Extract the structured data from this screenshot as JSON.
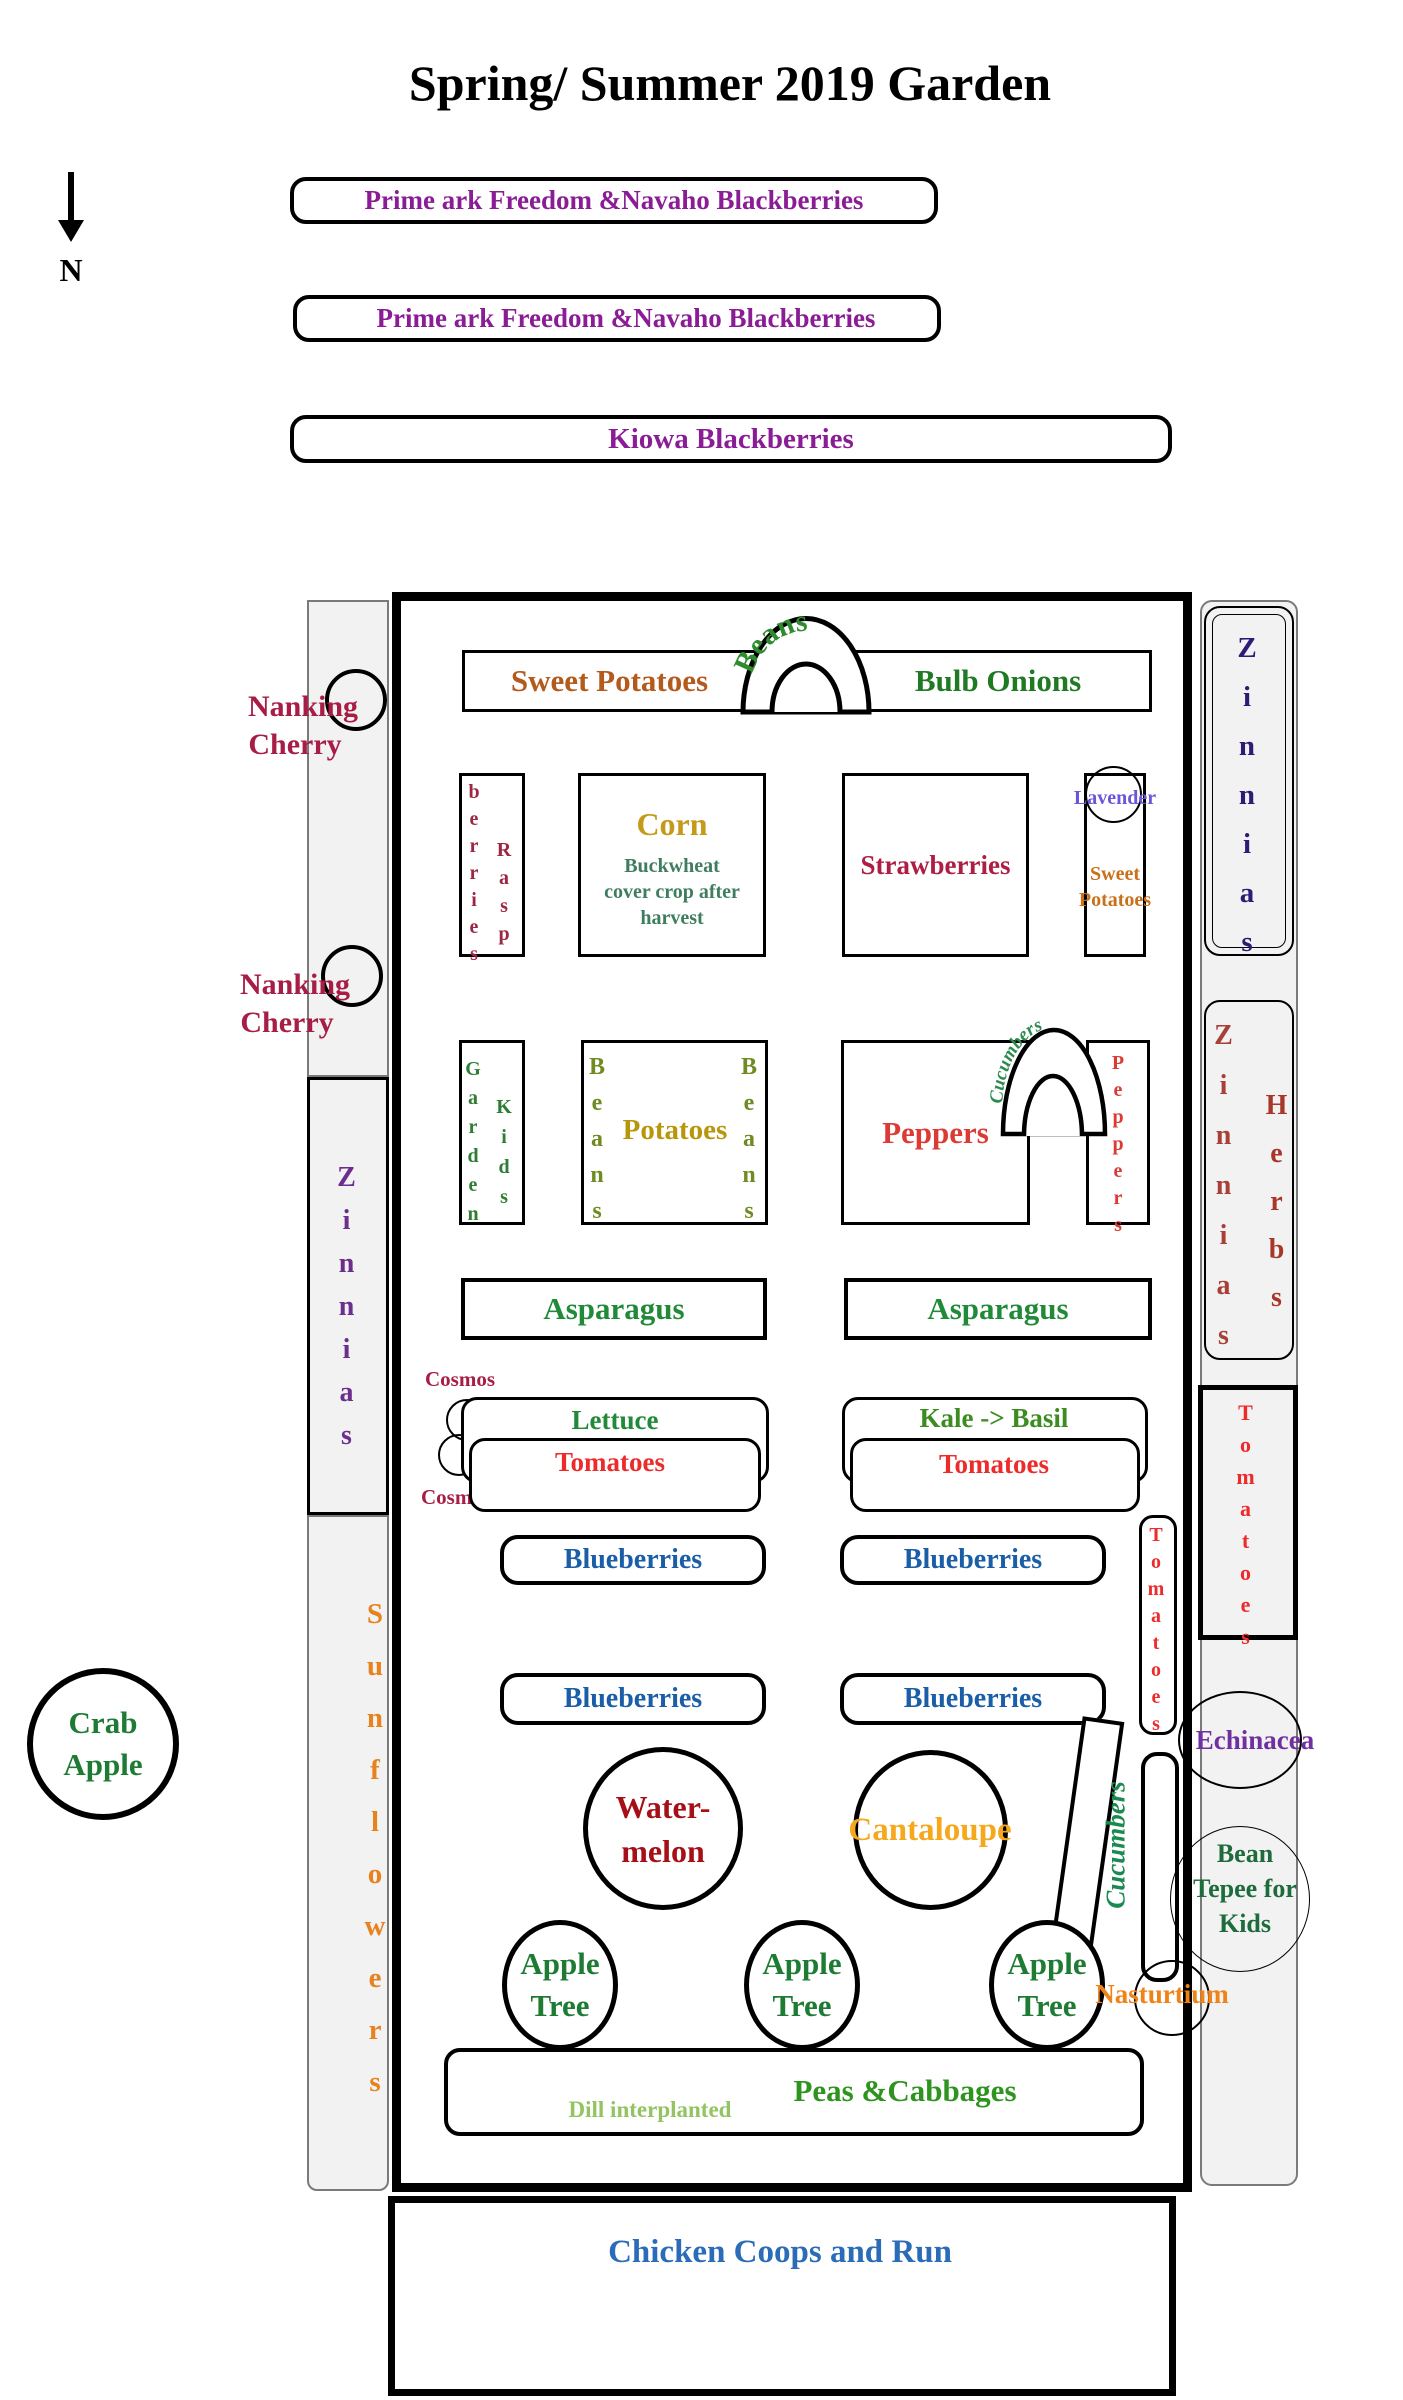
{
  "palette": {
    "blackberry_purple": "#8A1D96",
    "crimson": "#A81D45",
    "maroon_berry": "#9C2742",
    "strawberry_red": "#AE1E44",
    "tomato_red": "#ED2B2B",
    "pepper_red": "#DC3A35",
    "watermelon_dark_red": "#A50F15",
    "brick_zinnia": "#A84038",
    "herb_brick": "#A8372A",
    "orange_sweet_potato": "#B45A1D",
    "orange_small_sweet_potato": "#C8701A",
    "sunflower_orange": "#E8821E",
    "nasturtium_orange": "#F08318",
    "cantaloupe_amber": "#F5A81C",
    "corn_gold": "#C49A18",
    "potato_goldenrod": "#B8960C",
    "olive_beans": "#6F8B21",
    "green_main": "#218A39",
    "dark_green": "#1E7B34",
    "bulb_onion_green": "#1F7A23",
    "kale_green": "#3C8C21",
    "peas_green": "#2E941F",
    "dill_light_green": "#93C461",
    "buckwheat_teal_green": "#3E7D5E",
    "cucumber_green": "#1B8A50",
    "blueberry_blue": "#1A5EA8",
    "chicken_blue": "#2B6CB8",
    "navy_zinnia": "#2F1B75",
    "purple_zinnia": "#6B2D8E",
    "lavender_violet": "#6C55D8",
    "echinacea_purple": "#7030A0",
    "strip_gray": "#F2F2F2"
  },
  "title": "Spring/ Summer 2019 Garden",
  "compass_label": "N",
  "top_beds": {
    "row1": "Prime ark Freedom &Navaho Blackberries",
    "row2": "Prime ark Freedom &Navaho Blackberries",
    "row3": "Kiowa Blackberries"
  },
  "left_side": {
    "nanking1_line1": "Nanking",
    "nanking1_line2": "Cherry",
    "nanking2_line1": "Nanking",
    "nanking2_line2": "Cherry",
    "zinnias": "Zinnias",
    "sunflowers": "Sunflowers",
    "crab_line1": "Crab",
    "crab_line2": "Apple"
  },
  "right_side": {
    "zinnias_top": "Zinnias",
    "zinnias_mid": "Zinnias",
    "herbs": "Herbs",
    "tomatoes": "Tomatoes",
    "echinacea": "Echinacea",
    "bean_tepee_line1": "Bean",
    "bean_tepee_line2": "Tepee for",
    "bean_tepee_line3": "Kids"
  },
  "garden": {
    "sweet_potatoes": "Sweet Potatoes",
    "beans_arch": "Beans",
    "bulb_onions": "Bulb Onions",
    "rasp_col1": "berries",
    "rasp_col2": "Rasp",
    "corn": "Corn",
    "corn_note_line1": "Buckwheat",
    "corn_note_line2": "cover crop after",
    "corn_note_line3": "harvest",
    "strawberries": "Strawberries",
    "lavender": "Lavender",
    "sweet_potatoes_small_line1": "Sweet",
    "sweet_potatoes_small_line2": "Potatoes",
    "garden_col": "Garden",
    "kids_col": "Kids",
    "potatoes_beans_left": "Beans",
    "potatoes": "Potatoes",
    "potatoes_beans_right": "Beans",
    "peppers": "Peppers",
    "cucumbers_arch": "Cucumbers",
    "peppers_vertical": "Peppers",
    "asparagus_left": "Asparagus",
    "asparagus_right": "Asparagus",
    "cosmos1": "Cosmos",
    "cosmos2": "Cosmos",
    "lettuce": "Lettuce",
    "lettuce_tomatoes": "Tomatoes",
    "kale_basil": "Kale -> Basil",
    "kale_tomatoes": "Tomatoes",
    "blueberries": [
      "Blueberries",
      "Blueberries",
      "Blueberries",
      "Blueberries"
    ],
    "tomatoes_vertical": "Tomatoes",
    "watermelon_line1": "Water-",
    "watermelon_line2": "melon",
    "cantaloupe": "Cantaloupe",
    "cucumbers_trellis": "Cucumbers",
    "apple_line1": "Apple",
    "apple_line2": "Tree",
    "nasturtium": "Nasturtium",
    "dill_note": "Dill interplanted",
    "peas_cabbages": "Peas &Cabbages"
  },
  "chicken_run": "Chicken Coops and Run"
}
